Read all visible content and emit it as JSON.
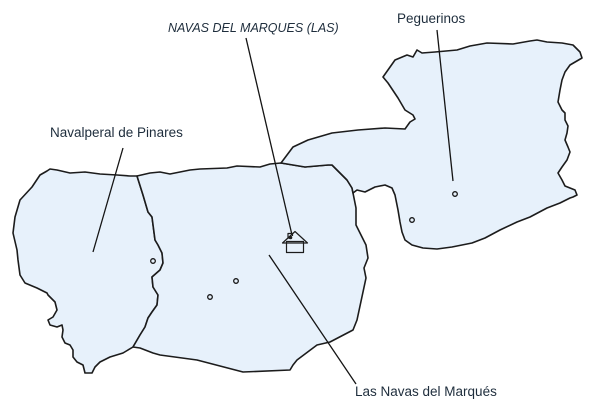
{
  "map": {
    "title_label": "NAVAS DEL MARQUES (LAS)",
    "regions": [
      {
        "id": "navalperal-de-pinares",
        "label": "Navalperal de Pinares"
      },
      {
        "id": "las-navas-del-marques",
        "label": "Las Navas del Marqués"
      },
      {
        "id": "peguerinos",
        "label": "Peguerinos"
      }
    ],
    "icons": {
      "town_hall": "house-icon",
      "town_marker": "dot-marker"
    },
    "colors": {
      "region_fill": "#e7f1fb",
      "boundary": "#1c1c1c",
      "label_text": "#1e2d3c",
      "background": "#ffffff"
    }
  }
}
